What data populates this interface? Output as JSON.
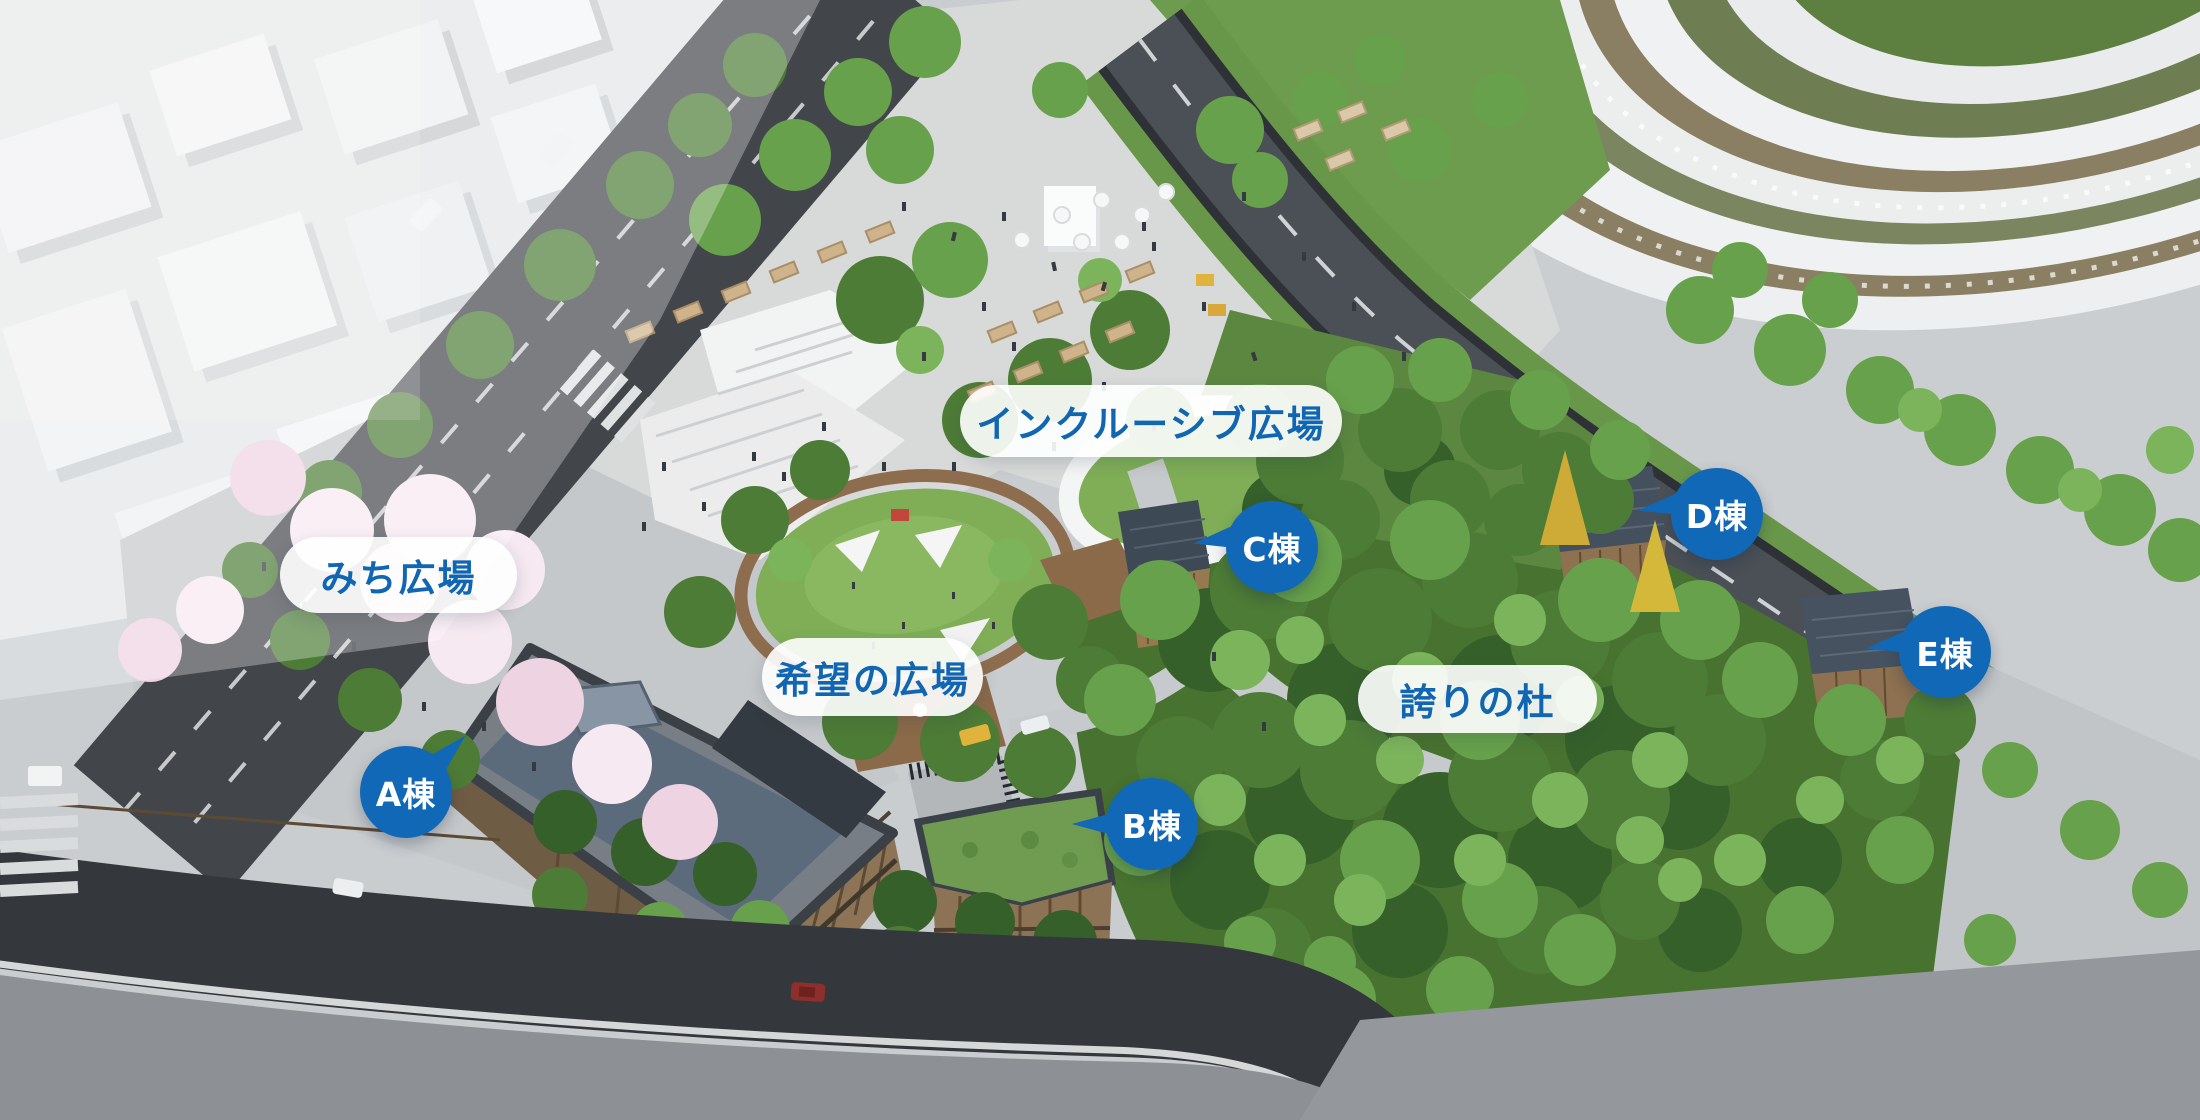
{
  "map": {
    "area_labels": [
      {
        "id": "inclusive-plaza",
        "label": "インクルーシブ広場"
      },
      {
        "id": "michi-plaza",
        "label": "みち広場"
      },
      {
        "id": "kibou-plaza",
        "label": "希望の広場"
      },
      {
        "id": "hokori-forest",
        "label": "誇りの杜"
      }
    ],
    "building_labels": [
      {
        "id": "building-a",
        "label": "A棟"
      },
      {
        "id": "building-b",
        "label": "B棟"
      },
      {
        "id": "building-c",
        "label": "C棟"
      },
      {
        "id": "building-d",
        "label": "D棟"
      },
      {
        "id": "building-e",
        "label": "E棟"
      }
    ],
    "colors": {
      "badge_blue": "#1168b7",
      "label_text_blue": "#1066b2",
      "pill_bg": "rgba(255,255,255,0.90)"
    }
  }
}
